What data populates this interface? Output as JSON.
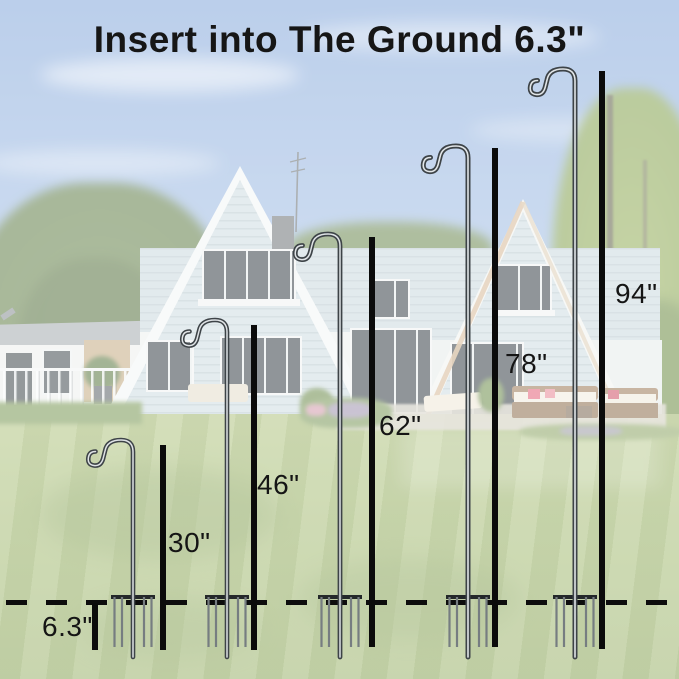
{
  "title": "Insert into The Ground 6.3\"",
  "depth": {
    "label": "6.3\"",
    "inches": 6.3
  },
  "hooks": [
    {
      "name": "hook-30",
      "label": "30\"",
      "inches": 30
    },
    {
      "name": "hook-46",
      "label": "46\"",
      "inches": 46
    },
    {
      "name": "hook-62",
      "label": "62\"",
      "inches": 62
    },
    {
      "name": "hook-78",
      "label": "78\"",
      "inches": 78
    },
    {
      "name": "hook-94",
      "label": "94\"",
      "inches": 94
    }
  ],
  "colors": {
    "annotation_black": "#0b0b0b",
    "text": "#151515",
    "metal_dark": "#3d4347",
    "metal_light": "#dfe3e6",
    "sky": "#a6c1e5",
    "lawn": "#9fb76b",
    "house_siding": "#cfdde2"
  }
}
